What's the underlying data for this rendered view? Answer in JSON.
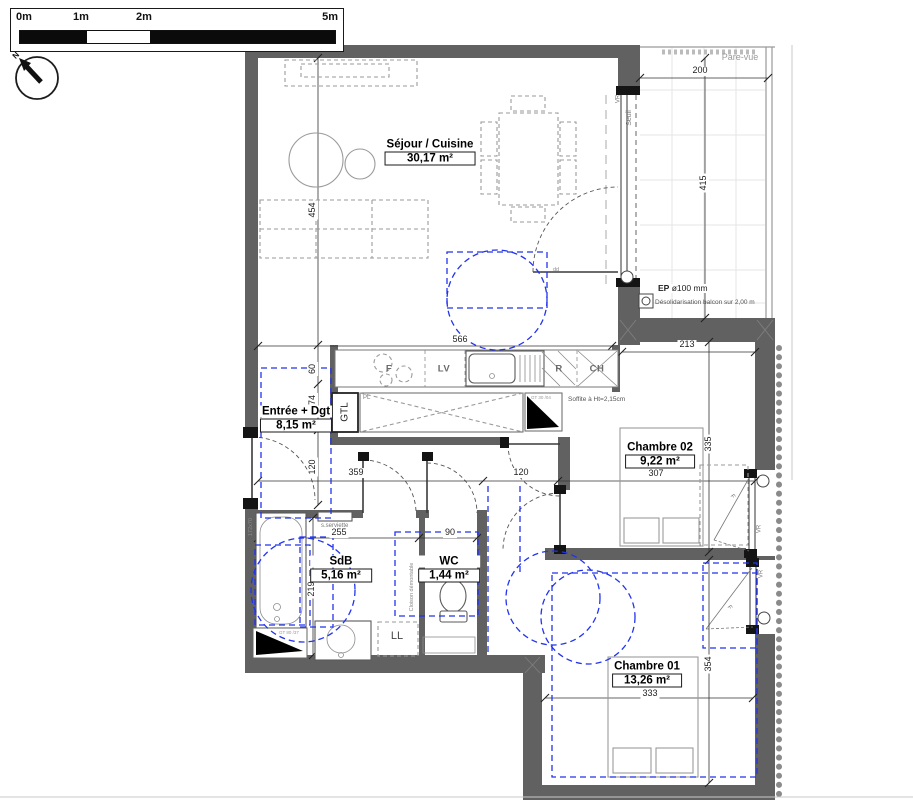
{
  "scalebar": {
    "label_0": "0m",
    "label_1": "1m",
    "label_2": "2m",
    "label_5": "5m"
  },
  "compass": {
    "north_label": "N"
  },
  "rooms": {
    "sejour": {
      "name": "Séjour / Cuisine",
      "area": "30,17 m²"
    },
    "entree": {
      "name": "Entrée + Dgt",
      "area": "8,15 m²"
    },
    "chambre02": {
      "name": "Chambre 02",
      "area": "9,22 m²"
    },
    "sdb": {
      "name": "SdB",
      "area": "5,16 m²"
    },
    "wc": {
      "name": "WC",
      "area": "1,44 m²"
    },
    "chambre01": {
      "name": "Chambre 01",
      "area": "13,26 m²"
    }
  },
  "appliances": {
    "f": "F",
    "lv": "LV",
    "r": "R",
    "ch": "CH"
  },
  "labels": {
    "gtl": "GTL",
    "pl": "PL",
    "ll": "LL",
    "pare_vue": "Pare-vue",
    "seuil": "Seuil",
    "vr": "VR",
    "ep_code": "EP",
    "ep_size": "ø100 mm",
    "desolidarisation": "Désolidarisation balcon sur 2,00 m",
    "soffite": "Soffite à Ht=2,15cm",
    "s_serviette": "s.serviette",
    "cloison_demontable": "Cloison démontable",
    "tub_size": "172x70",
    "window_f": "F",
    "gt_kitchen": "GT 30 /04",
    "gt_sdb": "GT 80 /37",
    "dd": "dd"
  },
  "dimensions": {
    "balcony_width": "200",
    "balcony_height": "415",
    "sejour_height": "454",
    "kitchen_width": "566",
    "below_balcony": "213",
    "chambre02_height": "335",
    "chambre02_width": "307",
    "hall_left": "359",
    "hall_mid": "120",
    "entry_60": "60",
    "entry_74": "74",
    "entry_120": "120",
    "sdb_width": "255",
    "wc_width": "90",
    "sdb_height": "219",
    "chambre01_width": "333",
    "chambre01_height": "354"
  },
  "colors": {
    "wall": "#616161",
    "accessibility_blue": "#2233ee",
    "furniture_gray": "#9a9a9a",
    "dimension_line": "#333333"
  }
}
